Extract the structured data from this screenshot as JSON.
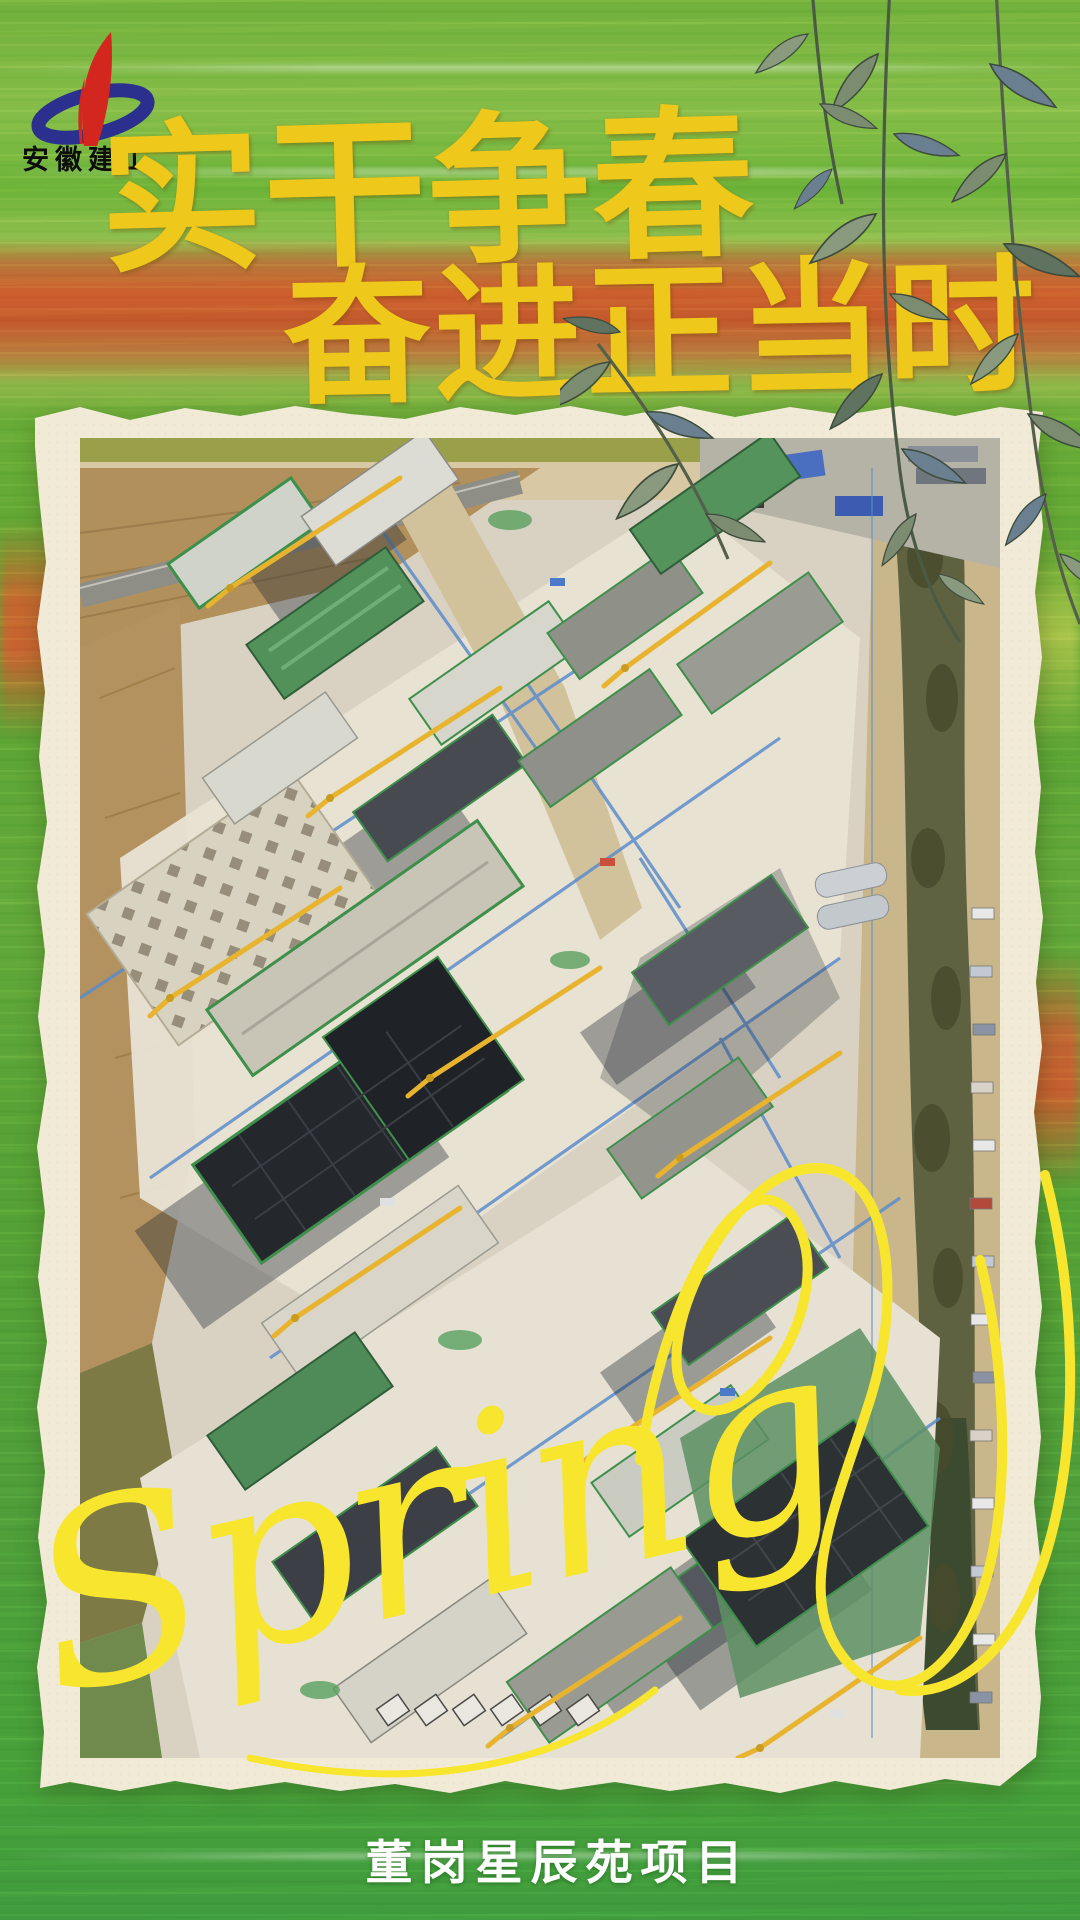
{
  "poster": {
    "brand": {
      "name": "安徽建工"
    },
    "title": {
      "line1": "实干争春",
      "line2": "奋进正当时"
    },
    "script_text": "Spring",
    "caption": "董岗星辰苑项目",
    "photo_alt": "Aerial drone view of the Donggang Xingchenyuan residential construction site: rows of buildings under construction covered in green safety netting, yellow tower cranes, blue layout lines on pale concrete ground, farmland strip on the left and a tree-lined boundary with parked cars on the right",
    "colors": {
      "accent_gold": "#eec81b",
      "script_yellow": "#f8e62e",
      "logo_red": "#d3261f",
      "logo_blue": "#2b2f8e",
      "frame_cream": "#f1ead7",
      "background_green": "#5fa836",
      "background_orange": "#cd6a33",
      "caption_white": "#ffffff"
    },
    "decor": {
      "foliage": "willow-branch",
      "frame_style": "torn-paper-photo-frame"
    }
  }
}
